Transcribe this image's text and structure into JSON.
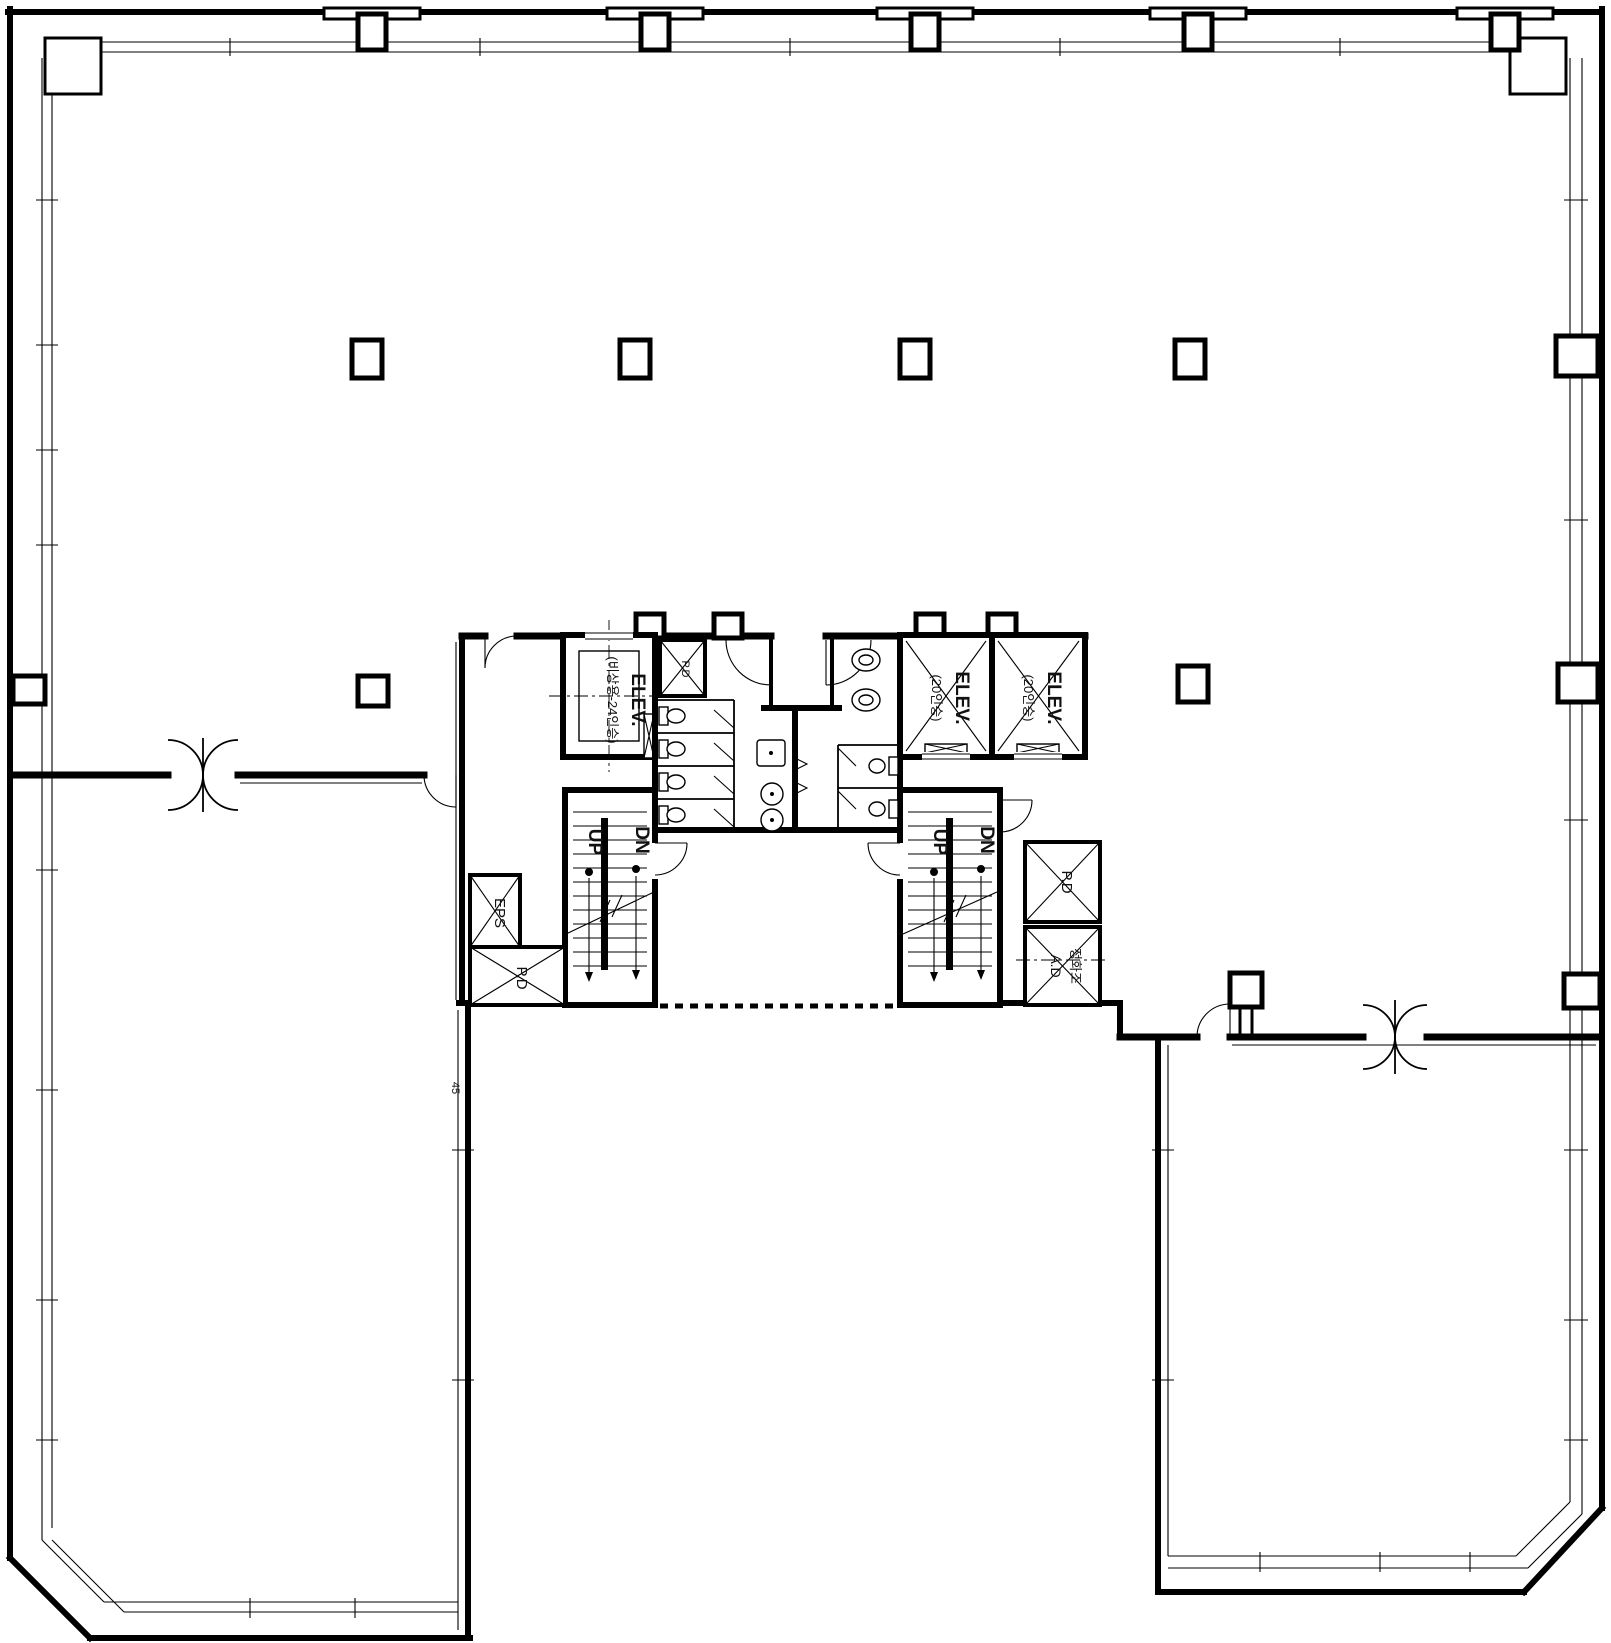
{
  "document": {
    "title": "Office tower typical floor plan"
  },
  "drawing": {
    "background": "#ffffff",
    "line_color": "#000000"
  },
  "labels": {
    "elev_service_line1": "ELEV.",
    "elev_service_line2": "(비상용-24인승)",
    "elev_passenger1_line1": "ELEV.",
    "elev_passenger1_line2": "(20인승)",
    "elev_passenger2_line1": "ELEV.",
    "elev_passenger2_line2": "(20인승)",
    "stair_left_up": "UP",
    "stair_left_dn": "DN",
    "stair_right_up": "UP",
    "stair_right_dn": "DN",
    "eps": "EPS",
    "pd_left": "P.D",
    "pd_toilet": "P.D",
    "pd_right": "P.D",
    "ad_line1": "정화조",
    "ad_line2": "A.D",
    "dim_note": "45"
  }
}
